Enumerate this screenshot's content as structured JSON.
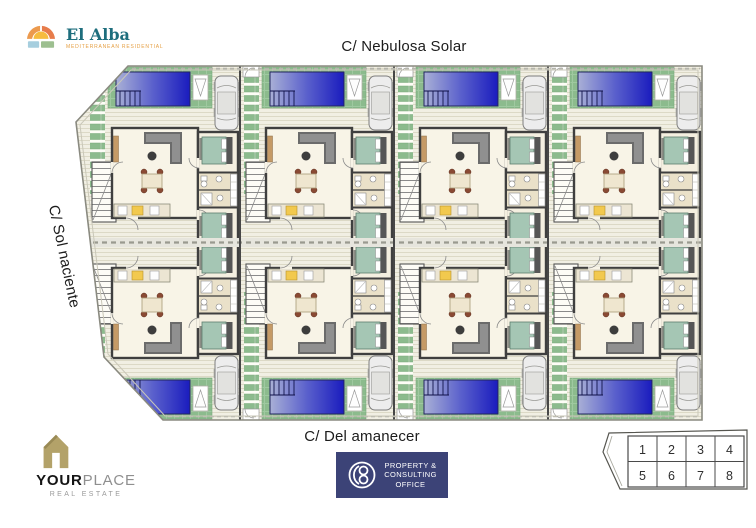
{
  "streets": {
    "top": "C/ Nebulosa Solar",
    "left": "C/ Sol naciente",
    "bottom": "C/ Del amanecer"
  },
  "branding": {
    "el_alba": {
      "name": "El Alba",
      "tagline": "MEDITERRANEAN RESIDENTIAL"
    },
    "yourplace": {
      "name_bold": "YOUR",
      "name_light": "PLACE",
      "subtitle": "REAL ESTATE"
    },
    "consulting_office": {
      "line1": "PROPERTY &",
      "line2": "CONSULTING",
      "line3": "OFFICE"
    }
  },
  "key_plan": {
    "cells": [
      "1",
      "2",
      "3",
      "4",
      "5",
      "6",
      "7",
      "8"
    ]
  },
  "site": {
    "layout": {
      "columns": 4,
      "rows": 2
    },
    "units": [
      {
        "plot": "1",
        "row": "top",
        "col": 0
      },
      {
        "plot": "2",
        "row": "top",
        "col": 1
      },
      {
        "plot": "3",
        "row": "top",
        "col": 2
      },
      {
        "plot": "4",
        "row": "top",
        "col": 3
      },
      {
        "plot": "5",
        "row": "bottom",
        "col": 0
      },
      {
        "plot": "6",
        "row": "bottom",
        "col": 1
      },
      {
        "plot": "7",
        "row": "bottom",
        "col": 2
      },
      {
        "plot": "8",
        "row": "bottom",
        "col": 3
      }
    ],
    "colors": {
      "pool_dark": "#1a1cbe",
      "pool_light": "#a9b0d6",
      "lawn_green": "#8cbb8d",
      "deck": "#f1efe3",
      "wall": "#3f3f3f",
      "bed_teal": "#a5c6b4",
      "badge_navy": "#3c4377",
      "gold": "#b3a269",
      "elalba_teal": "#1e6e7d",
      "elalba_orange": "#e59f43"
    }
  }
}
